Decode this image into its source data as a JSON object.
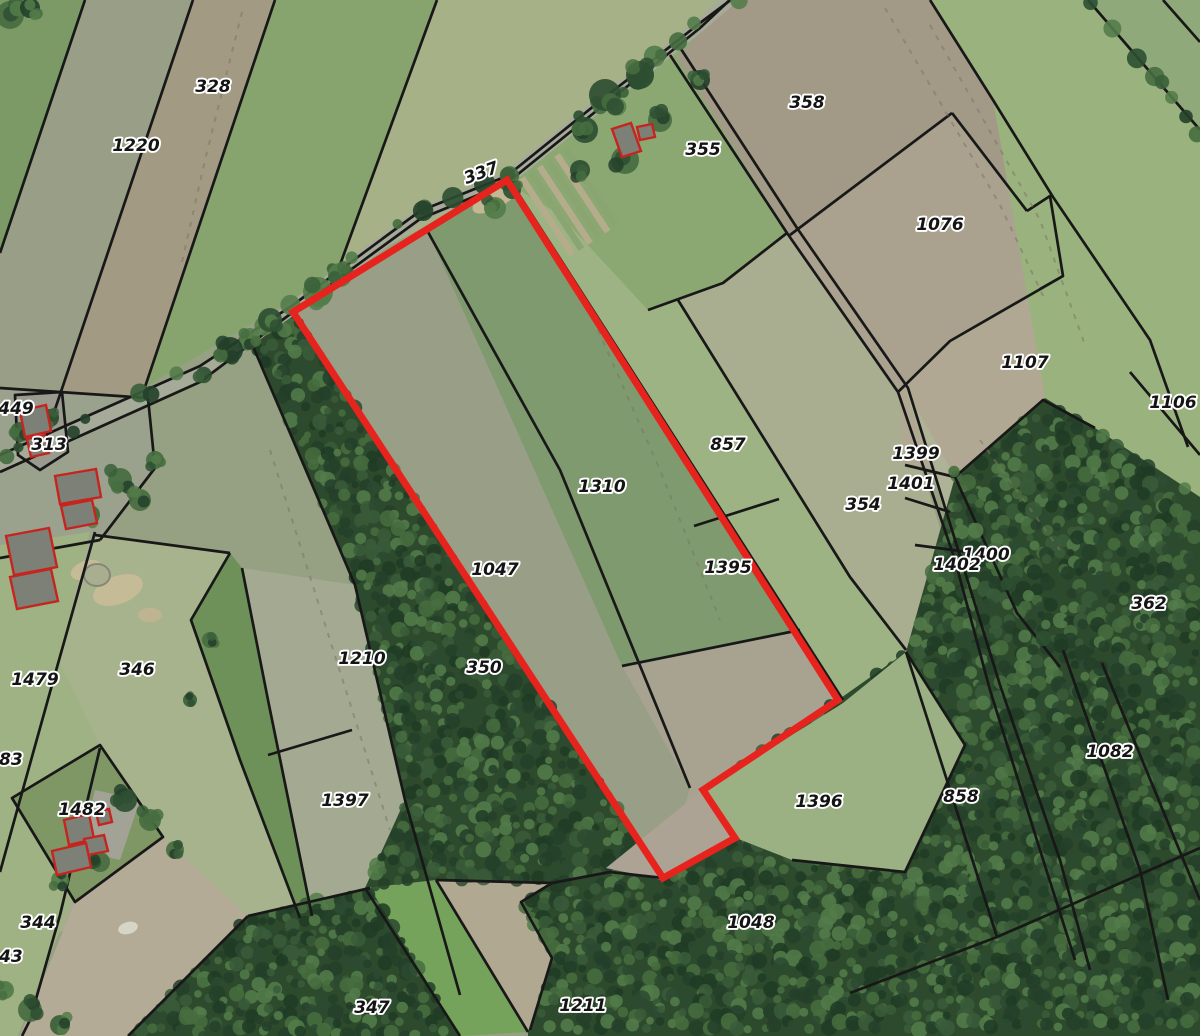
{
  "app": {
    "name": "cadastral-map-view"
  },
  "canvas": {
    "width": 1200,
    "height": 1036,
    "background": "#95a182"
  },
  "label_style": {
    "font_size": 17,
    "fill": "#141414",
    "halo": "#ffffff",
    "halo_width": 3.8
  },
  "parcel_labels": [
    {
      "text": "328",
      "x": 213,
      "y": 92
    },
    {
      "text": "1220",
      "x": 136,
      "y": 151
    },
    {
      "text": "337",
      "x": 483,
      "y": 178,
      "rot": -20
    },
    {
      "text": "355",
      "x": 703,
      "y": 155
    },
    {
      "text": "358",
      "x": 807,
      "y": 108
    },
    {
      "text": "1076",
      "x": 940,
      "y": 230
    },
    {
      "text": "1107",
      "x": 1025,
      "y": 368
    },
    {
      "text": "1106",
      "x": 1173,
      "y": 408
    },
    {
      "text": "449",
      "x": 16,
      "y": 414
    },
    {
      "text": "313",
      "x": 49,
      "y": 450
    },
    {
      "text": "857",
      "x": 728,
      "y": 450
    },
    {
      "text": "1399",
      "x": 916,
      "y": 459
    },
    {
      "text": "1401",
      "x": 911,
      "y": 489
    },
    {
      "text": "1310",
      "x": 602,
      "y": 492
    },
    {
      "text": "354",
      "x": 863,
      "y": 510
    },
    {
      "text": "1400",
      "x": 986,
      "y": 560
    },
    {
      "text": "1402",
      "x": 957,
      "y": 570
    },
    {
      "text": "1047",
      "x": 495,
      "y": 575
    },
    {
      "text": "1395",
      "x": 728,
      "y": 573
    },
    {
      "text": "362",
      "x": 1149,
      "y": 609
    },
    {
      "text": "1210",
      "x": 362,
      "y": 664
    },
    {
      "text": "350",
      "x": 484,
      "y": 673
    },
    {
      "text": "346",
      "x": 137,
      "y": 675
    },
    {
      "text": "1479",
      "x": 35,
      "y": 685
    },
    {
      "text": "383",
      "x": 5,
      "y": 765
    },
    {
      "text": "1397",
      "x": 345,
      "y": 806
    },
    {
      "text": "1396",
      "x": 819,
      "y": 807
    },
    {
      "text": "858",
      "x": 961,
      "y": 802
    },
    {
      "text": "1082",
      "x": 1110,
      "y": 757
    },
    {
      "text": "1482",
      "x": 82,
      "y": 815
    },
    {
      "text": "344",
      "x": 38,
      "y": 928
    },
    {
      "text": "1048",
      "x": 751,
      "y": 928
    },
    {
      "text": "343",
      "x": 5,
      "y": 962
    },
    {
      "text": "347",
      "x": 372,
      "y": 1013
    },
    {
      "text": "1211",
      "x": 583,
      "y": 1011
    }
  ],
  "highlight": {
    "name": "selected-parcel-outline",
    "color": "#e7231d",
    "width": 7,
    "points": "507,180 838,700 703,790 735,838 663,878 293,312"
  },
  "fields": [
    {
      "name": "field-nw-green",
      "color": "#7c9a66",
      "points": "0,0 85,0 0,253"
    },
    {
      "name": "field-1220",
      "color": "#999f87",
      "points": "85,0 193,0 43,445 0,462 0,253"
    },
    {
      "name": "field-328",
      "color": "#a39a84",
      "points": "193,0 275,0 145,387 43,445"
    },
    {
      "name": "field-nw-green2",
      "color": "#87a36e",
      "points": "275,0 437,0 337,273 145,387"
    },
    {
      "name": "field-nw-pale",
      "color": "#a6b188",
      "points": "437,0 742,0 507,183 337,273"
    },
    {
      "name": "field-355",
      "color": "#8ba873",
      "points": "734,-2 700,28 660,62 600,108 507,183 560,215 648,310 723,283 787,233 677,57"
    },
    {
      "name": "field-857-1395",
      "color": "#9db383",
      "points": "516,188 838,700 843,703 906,652 850,577 678,300 648,310 560,215"
    },
    {
      "name": "field-354",
      "color": "#a8ae8f",
      "points": "723,283 787,233 898,392 990,690 1010,770 950,795 906,652 850,577 678,300"
    },
    {
      "name": "field-358",
      "color": "#a29a87",
      "points": "677,57 734,-2 930,0 993,100 1050,196 1027,211 952,113 790,235"
    },
    {
      "name": "field-1076",
      "color": "#aaa28f",
      "points": "790,235 952,113 1027,211 1063,276 950,341 898,392 787,233"
    },
    {
      "name": "field-1107",
      "color": "#b1a893",
      "points": "898,392 950,341 1063,276 1150,340 1188,447 1045,398 955,477 905,465"
    },
    {
      "name": "field-lane-strips",
      "color": "#aeb296",
      "points": "905,388 1000,685 1062,860 1020,616 956,478"
    },
    {
      "name": "field-ne-big",
      "color": "#9ab37e",
      "points": "930,0 1088,0 1200,130 1200,497 1095,428 1045,398 993,100"
    },
    {
      "name": "field-ne-corner",
      "color": "#90a97a",
      "points": "1088,0 1200,0 1200,130"
    },
    {
      "name": "field-farm-313",
      "color": "#9aa18c",
      "points": "0,388 148,398 155,468 100,540 0,558"
    },
    {
      "name": "field-west-base",
      "color": "#a7ac91",
      "points": "0,558 100,540 95,535 230,553 300,920 248,916 115,905 0,962"
    },
    {
      "name": "field-west-grass",
      "color": "#9fb283",
      "points": "0,545 90,532 60,655 98,745 72,900 18,1036 0,1036"
    },
    {
      "name": "field-346",
      "color": "#a6b38c",
      "points": "95,535 230,553 191,620 240,760 300,918 248,916 163,837 100,745 58,660"
    },
    {
      "name": "field-green-strip",
      "color": "#6d9159",
      "points": "230,553 242,568 268,700 312,916 300,918 240,760 191,620"
    },
    {
      "name": "field-1210-1397",
      "color": "#a4a991",
      "points": "242,568 355,585 405,800 460,995 312,916 268,700"
    },
    {
      "name": "field-1482",
      "color": "#7f9765",
      "points": "12,798 100,745 163,837 75,902"
    },
    {
      "name": "field-bottom-tan",
      "color": "#b3ab96",
      "points": "163,837 250,918 128,1036 20,1036 75,902"
    },
    {
      "name": "field-tan-pocket",
      "color": "#b1a892",
      "points": "436,880 552,883 521,902 552,958 530,1030 528,1032"
    },
    {
      "name": "field-bright-strip",
      "color": "#76a35b",
      "points": "365,888 436,880 528,1032 460,1036"
    },
    {
      "name": "parcel-1047-interior",
      "color": "#999e87",
      "points": "293,312 428,232 690,788 663,878"
    },
    {
      "name": "parcel-1310-interior",
      "color": "#7f9a6e",
      "points": "428,232 507,180 838,700 800,630 622,666"
    },
    {
      "name": "parcel-interior-south",
      "color": "#a8a391",
      "points": "622,666 800,630 838,700 703,790 735,838 663,878 690,788"
    },
    {
      "name": "farmyard-313",
      "color": "#9b9a8e",
      "points": "15,395 62,392 68,452 40,470 18,455"
    },
    {
      "name": "farmyard-1482",
      "color": "#a3a296",
      "points": "95,790 140,800 120,860 80,850"
    }
  ],
  "forests": [
    {
      "name": "forest-350",
      "points": "254,345 293,312 663,878 610,872 552,883 436,880 365,888 405,800 355,585"
    },
    {
      "name": "forest-347",
      "points": "248,916 370,888 460,1036 128,1036"
    },
    {
      "name": "forest-southeast",
      "points": "528,1032 552,958 521,902 552,883 610,872 663,878 735,838 703,790 838,700 906,652 955,477 1045,398 1095,428 1200,497 1200,1036 528,1036"
    }
  ],
  "forest_base": "#2e4a2c",
  "forest_palette": [
    "#23402a",
    "#2c4a30",
    "#3a5c3a",
    "#466d40",
    "#547c4a",
    "#1f3b24"
  ],
  "overlays": [
    {
      "name": "grass-1396",
      "color": "#9cb183",
      "points": "843,703 906,652 965,745 905,872 792,860 736,838 704,790"
    },
    {
      "name": "tan-red-tip",
      "color": "#ada394",
      "points": "606,868 700,792 738,836 662,880"
    }
  ],
  "road": {
    "name": "road",
    "color": "#a6aa98",
    "width": 13,
    "points": "0,463 200,374 293,308 420,215 507,179 600,104 658,59 700,25 736,-6"
  },
  "boundary_style": {
    "color": "#181818",
    "width": 2.7
  },
  "boundaries": [
    {
      "points": "0,455 200,366 293,305 420,211 507,176 600,101 658,56 700,23 736,-4"
    },
    {
      "points": "0,472 200,382 293,312 420,219 507,183 600,108 658,62 700,28 734,-4"
    },
    {
      "points": "85,0 0,253"
    },
    {
      "points": "193,0 43,445"
    },
    {
      "points": "275,0 145,387"
    },
    {
      "points": "437,0 337,273"
    },
    {
      "points": "670,55 787,233 898,392 955,560 990,690"
    },
    {
      "points": "681,49 797,228 908,388 1000,685"
    },
    {
      "points": "990,690 1040,850 1075,960"
    },
    {
      "points": "1000,685 1060,860 1090,970"
    },
    {
      "points": "905,498 950,512"
    },
    {
      "points": "915,545 968,552"
    },
    {
      "points": "678,300 850,577 906,650"
    },
    {
      "points": "648,310 723,283 787,233"
    },
    {
      "points": "694,526 779,499"
    },
    {
      "points": "790,235 952,113"
    },
    {
      "points": "952,113 1027,211"
    },
    {
      "points": "1027,211 1050,196 1063,276 1040,289"
    },
    {
      "points": "1063,276 950,341 898,392"
    },
    {
      "points": "930,0 993,100 1053,197 1150,340 1188,447"
    },
    {
      "points": "1130,372 1200,455"
    },
    {
      "points": "905,465 955,477 1043,400 1095,428"
    },
    {
      "points": "955,477 1017,613 1060,667"
    },
    {
      "points": "906,652 997,937"
    },
    {
      "points": "997,937 1075,903 1200,848"
    },
    {
      "points": "850,993 997,937"
    },
    {
      "points": "1063,650 1140,870 1168,1000"
    },
    {
      "points": "1102,663 1200,900"
    },
    {
      "points": "1088,0 1200,130"
    },
    {
      "points": "1163,0 1200,42"
    },
    {
      "points": "428,232 560,470 690,788"
    },
    {
      "points": "622,666 800,630"
    },
    {
      "points": "516,190 843,700"
    },
    {
      "points": "230,553 191,620 240,760 300,918"
    },
    {
      "points": "242,568 268,700 312,916"
    },
    {
      "points": "252,344 355,585 405,800 460,995"
    },
    {
      "points": "268,755 352,730"
    },
    {
      "points": "95,535 230,553"
    },
    {
      "points": "148,398 155,468 100,540"
    },
    {
      "points": "0,388 148,398"
    },
    {
      "points": "100,540 0,558"
    },
    {
      "points": "95,532 52,685 18,807 0,872"
    },
    {
      "points": "100,748 60,915 30,1020 22,1036"
    },
    {
      "points": "12,798 100,745 163,837 75,902",
      "closed": true
    },
    {
      "points": "15,395 62,392 68,452 40,470 18,455",
      "closed": true
    },
    {
      "points": "248,916 370,888"
    },
    {
      "points": "248,916 128,1036"
    },
    {
      "points": "365,888 460,1036"
    },
    {
      "points": "436,880 528,1032"
    },
    {
      "points": "436,880 552,883 521,902 552,958 530,1030"
    },
    {
      "points": "552,883 610,872 663,878"
    },
    {
      "points": "906,652 965,745 905,872 792,860"
    },
    {
      "points": "293,312 507,180 838,700 703,790 735,838 663,878",
      "closed": true
    }
  ],
  "track_style": {
    "color": "#7e7566",
    "width": 2,
    "dash": "5 7",
    "opacity": 0.55
  },
  "tracks": [
    {
      "points": "242,12 205,160 182,262"
    },
    {
      "points": "885,8 1000,205 1045,300"
    },
    {
      "points": "930,25 1040,220 1085,345"
    },
    {
      "points": "980,440 1060,550"
    },
    {
      "points": "598,330 660,470 720,620"
    },
    {
      "points": "270,450 330,640 390,830"
    }
  ],
  "tree_palette": [
    "#23402a",
    "#2e4f31",
    "#3a5f3a",
    "#466d40",
    "#547c4a"
  ],
  "tree_lines": [
    {
      "points": "0,458 200,370 293,306 420,213 507,178 600,103 658,58 700,24 734,-4",
      "step": 24,
      "jitter": 7,
      "rmin": 5,
      "rmax": 11
    },
    {
      "points": "1088,0 1200,130",
      "step": 18,
      "jitter": 5,
      "rmin": 6,
      "rmax": 10
    },
    {
      "points": "955,477 1017,613 1060,667",
      "step": 26,
      "jitter": 6,
      "rmin": 5,
      "rmax": 9
    }
  ],
  "tree_clusters": [
    {
      "x": 10,
      "y": 15,
      "r": 14
    },
    {
      "x": 30,
      "y": 8,
      "r": 10
    },
    {
      "x": 318,
      "y": 292,
      "r": 15
    },
    {
      "x": 340,
      "y": 275,
      "r": 12
    },
    {
      "x": 230,
      "y": 350,
      "r": 13
    },
    {
      "x": 250,
      "y": 338,
      "r": 10
    },
    {
      "x": 270,
      "y": 320,
      "r": 12
    },
    {
      "x": 20,
      "y": 432,
      "r": 10
    },
    {
      "x": 50,
      "y": 418,
      "r": 9
    },
    {
      "x": 605,
      "y": 95,
      "r": 16
    },
    {
      "x": 640,
      "y": 75,
      "r": 14
    },
    {
      "x": 585,
      "y": 130,
      "r": 13
    },
    {
      "x": 660,
      "y": 120,
      "r": 12
    },
    {
      "x": 700,
      "y": 80,
      "r": 10
    },
    {
      "x": 625,
      "y": 160,
      "r": 14
    },
    {
      "x": 580,
      "y": 170,
      "r": 10
    },
    {
      "x": 495,
      "y": 208,
      "r": 11
    },
    {
      "x": 512,
      "y": 190,
      "r": 9
    },
    {
      "x": 120,
      "y": 480,
      "r": 12
    },
    {
      "x": 140,
      "y": 500,
      "r": 11
    },
    {
      "x": 90,
      "y": 515,
      "r": 10
    },
    {
      "x": 155,
      "y": 460,
      "r": 9
    },
    {
      "x": 125,
      "y": 800,
      "r": 12
    },
    {
      "x": 150,
      "y": 820,
      "r": 11
    },
    {
      "x": 100,
      "y": 862,
      "r": 10
    },
    {
      "x": 175,
      "y": 850,
      "r": 9
    },
    {
      "x": 60,
      "y": 880,
      "r": 9
    },
    {
      "x": 30,
      "y": 1010,
      "r": 12
    },
    {
      "x": 60,
      "y": 1025,
      "r": 10
    },
    {
      "x": 5,
      "y": 990,
      "r": 9
    },
    {
      "x": 210,
      "y": 640,
      "r": 8
    },
    {
      "x": 190,
      "y": 700,
      "r": 7
    }
  ],
  "building_style": {
    "fill": "#7d8076",
    "stroke": "#c6241e",
    "width": 2.4
  },
  "buildings": [
    {
      "points": "612,129 631,123 641,151 622,157"
    },
    {
      "points": "637,127 652,124 655,137 640,140"
    },
    {
      "points": "20,411 46,405 51,431 25,437"
    },
    {
      "points": "27,439 45,435 49,453 31,457"
    },
    {
      "points": "55,476 96,469 101,497 60,504"
    },
    {
      "points": "61,506 92,500 97,523 66,529"
    },
    {
      "points": "6,536 49,528 57,567 14,575"
    },
    {
      "points": "10,577 51,569 58,601 17,609"
    },
    {
      "points": "64,820 89,814 94,839 69,845"
    },
    {
      "points": "84,839 104,835 108,851 88,855"
    },
    {
      "points": "52,851 86,843 91,867 57,875"
    },
    {
      "points": "96,812 109,809 112,822 99,825"
    }
  ],
  "sand_patches": [
    {
      "cx": 497,
      "cy": 196,
      "rx": 28,
      "ry": 11,
      "rot": -32,
      "color": "#c2b893"
    },
    {
      "cx": 118,
      "cy": 590,
      "rx": 26,
      "ry": 14,
      "rot": -20,
      "color": "#c6bb97"
    },
    {
      "cx": 86,
      "cy": 570,
      "rx": 16,
      "ry": 9,
      "rot": -20,
      "color": "#c6bb97"
    },
    {
      "cx": 150,
      "cy": 615,
      "rx": 12,
      "ry": 7,
      "rot": 0,
      "color": "#bfb492"
    },
    {
      "cx": 128,
      "cy": 928,
      "rx": 10,
      "ry": 6,
      "rot": -15,
      "color": "#d8d5c6"
    }
  ],
  "pond": {
    "cx": 97,
    "cy": 575,
    "rx": 13,
    "ry": 11,
    "fill": "#a9ae91",
    "stroke": "#848875"
  },
  "garden": {
    "x": 522,
    "y": 178,
    "dir": [
      0.55,
      0.835
    ],
    "stripe_len": 92,
    "stripe_w": 6.5,
    "gap": 10.5,
    "count": 6,
    "colors": [
      "#b5ac8c",
      "#8aa571"
    ]
  }
}
